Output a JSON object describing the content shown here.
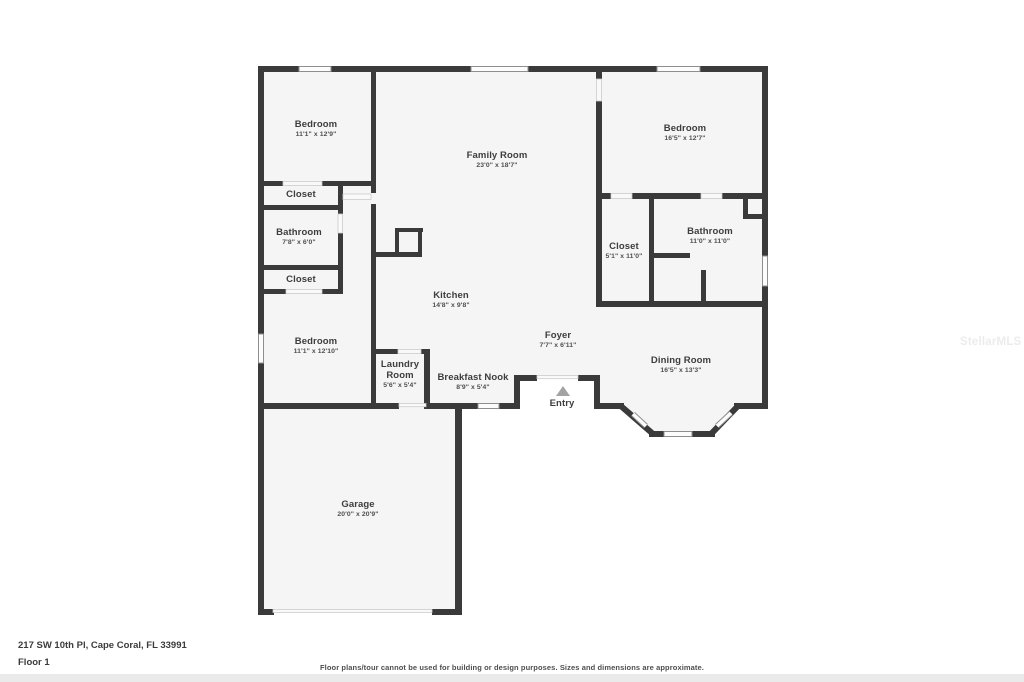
{
  "floorplan": {
    "rooms": [
      {
        "name": "Bedroom",
        "dims": "11'1\" x 12'9\""
      },
      {
        "name": "Closet",
        "dims": ""
      },
      {
        "name": "Bathroom",
        "dims": "7'8\" x 6'0\""
      },
      {
        "name": "Closet",
        "dims": ""
      },
      {
        "name": "Bedroom",
        "dims": "11'1\" x 12'10\""
      },
      {
        "name": "Family Room",
        "dims": "23'0\" x 18'7\""
      },
      {
        "name": "Kitchen",
        "dims": "14'8\" x 9'8\""
      },
      {
        "name": "Laundry Room",
        "dims": "5'6\" x 5'4\""
      },
      {
        "name": "Breakfast Nook",
        "dims": "8'9\" x 5'4\""
      },
      {
        "name": "Foyer",
        "dims": "7'7\" x 6'11\""
      },
      {
        "name": "Entry",
        "dims": ""
      },
      {
        "name": "Dining Room",
        "dims": "16'5\" x 13'3\""
      },
      {
        "name": "Bedroom",
        "dims": "16'5\" x 12'7\""
      },
      {
        "name": "Closet",
        "dims": "5'1\" x 11'0\""
      },
      {
        "name": "Bathroom",
        "dims": "11'0\" x 11'0\""
      },
      {
        "name": "Garage",
        "dims": "20'0\" x 20'9\""
      }
    ],
    "icons": {
      "entry_arrow": "triangle-up"
    },
    "colors": {
      "wall": "#3a3a3a",
      "room_fill": "#f5f5f5",
      "window_frame": "#8e8e8e",
      "entry_arrow": "#a3a3a3",
      "footer_strip": "#eaeaea",
      "watermark": "#ececec"
    }
  },
  "footer": {
    "address": "217 SW 10th Pl, Cape Coral, FL 33991",
    "floor_label": "Floor 1",
    "disclaimer": "Floor plans/tour cannot be used for building or design purposes. Sizes and dimensions are approximate."
  },
  "watermark": {
    "text": "StellarMLS"
  }
}
